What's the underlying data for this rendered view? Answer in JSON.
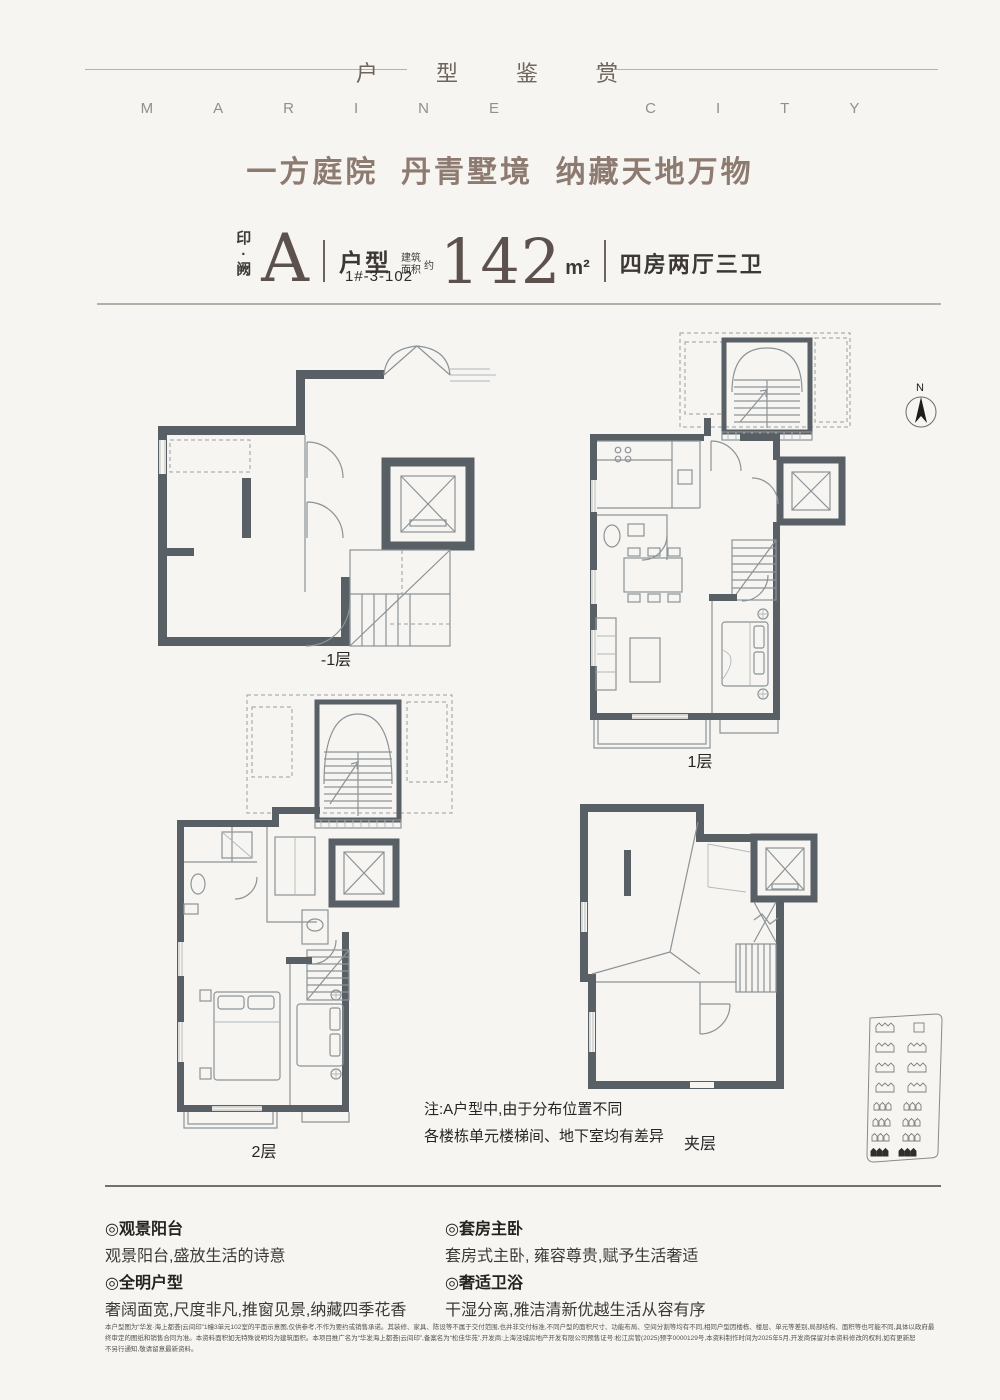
{
  "header": {
    "title_cn": "户 型 鉴 赏",
    "subtitle_en": "MARINE CITY"
  },
  "slogan": "一方庭院  丹青墅境  纳藏天地万物",
  "unit": {
    "seal": "印\n·\n阙",
    "type_letter": "A",
    "type_label": "户型",
    "area_prefix_line1": "建筑",
    "area_prefix_line2": "面积",
    "area_prefix_approx": "约",
    "area_value": "142",
    "area_unit": "m²",
    "rooms": "四房两厅三卫",
    "unit_number": "1#-3-102"
  },
  "plans": [
    {
      "id": "basement",
      "label": "-1层"
    },
    {
      "id": "first-floor",
      "label": "1层"
    },
    {
      "id": "second-floor",
      "label": "2层"
    },
    {
      "id": "mezzanine",
      "label": "夹层"
    }
  ],
  "compass": {
    "label": "N"
  },
  "note": {
    "line1": "注:A户型中,由于分布位置不同",
    "line2": "各楼栋单元楼梯间、地下室均有差异"
  },
  "features": {
    "left": [
      {
        "title": "◎观景阳台",
        "desc": "观景阳台,盛放生活的诗意"
      },
      {
        "title": "◎全明户型",
        "desc": "奢阔面宽,尺度非凡,推窗见景,纳藏四季花香"
      }
    ],
    "right": [
      {
        "title": "◎套房主卧",
        "desc": "套房式主卧, 雍容尊贵,赋予生活奢适"
      },
      {
        "title": "◎奢适卫浴",
        "desc": "干湿分离,雅洁清新优越生活从容有序"
      }
    ]
  },
  "disclaimer": {
    "line1": "本户型图为“华发·海上都荟|云间印”1幢3单元102室的平面示意图,仅供参考,不作为要约或销售承诺。其装修、家具、陈设等不属于交付范围,也并非交付标准,不同户型的面积尺寸、功能布局、空间分割等均有不同,相同户型因楼栋、楼层、单元等差别,局部结构、面积等也可能不同,具体以政府最",
    "line2": "终审定的图纸和销售合同为准。本资料面积如无特殊说明均为建筑面积。本项目推广名为“华发海上都荟|云间印”,备案名为“松佳华苑”,开发商:上海泾城房地产开发有限公司预售证号:松江房管(2025)预字0000129号,本资料制作时间为2025年5月,开发商保留对本资料修改的权利,如有更新恕",
    "line3": "不另行通知,敬请留意最新资料。"
  },
  "colors": {
    "accent_brown": "#8d7a70",
    "dark_taupe": "#5d514d",
    "wall_gray": "#586066",
    "background": "#f6f5f1"
  }
}
